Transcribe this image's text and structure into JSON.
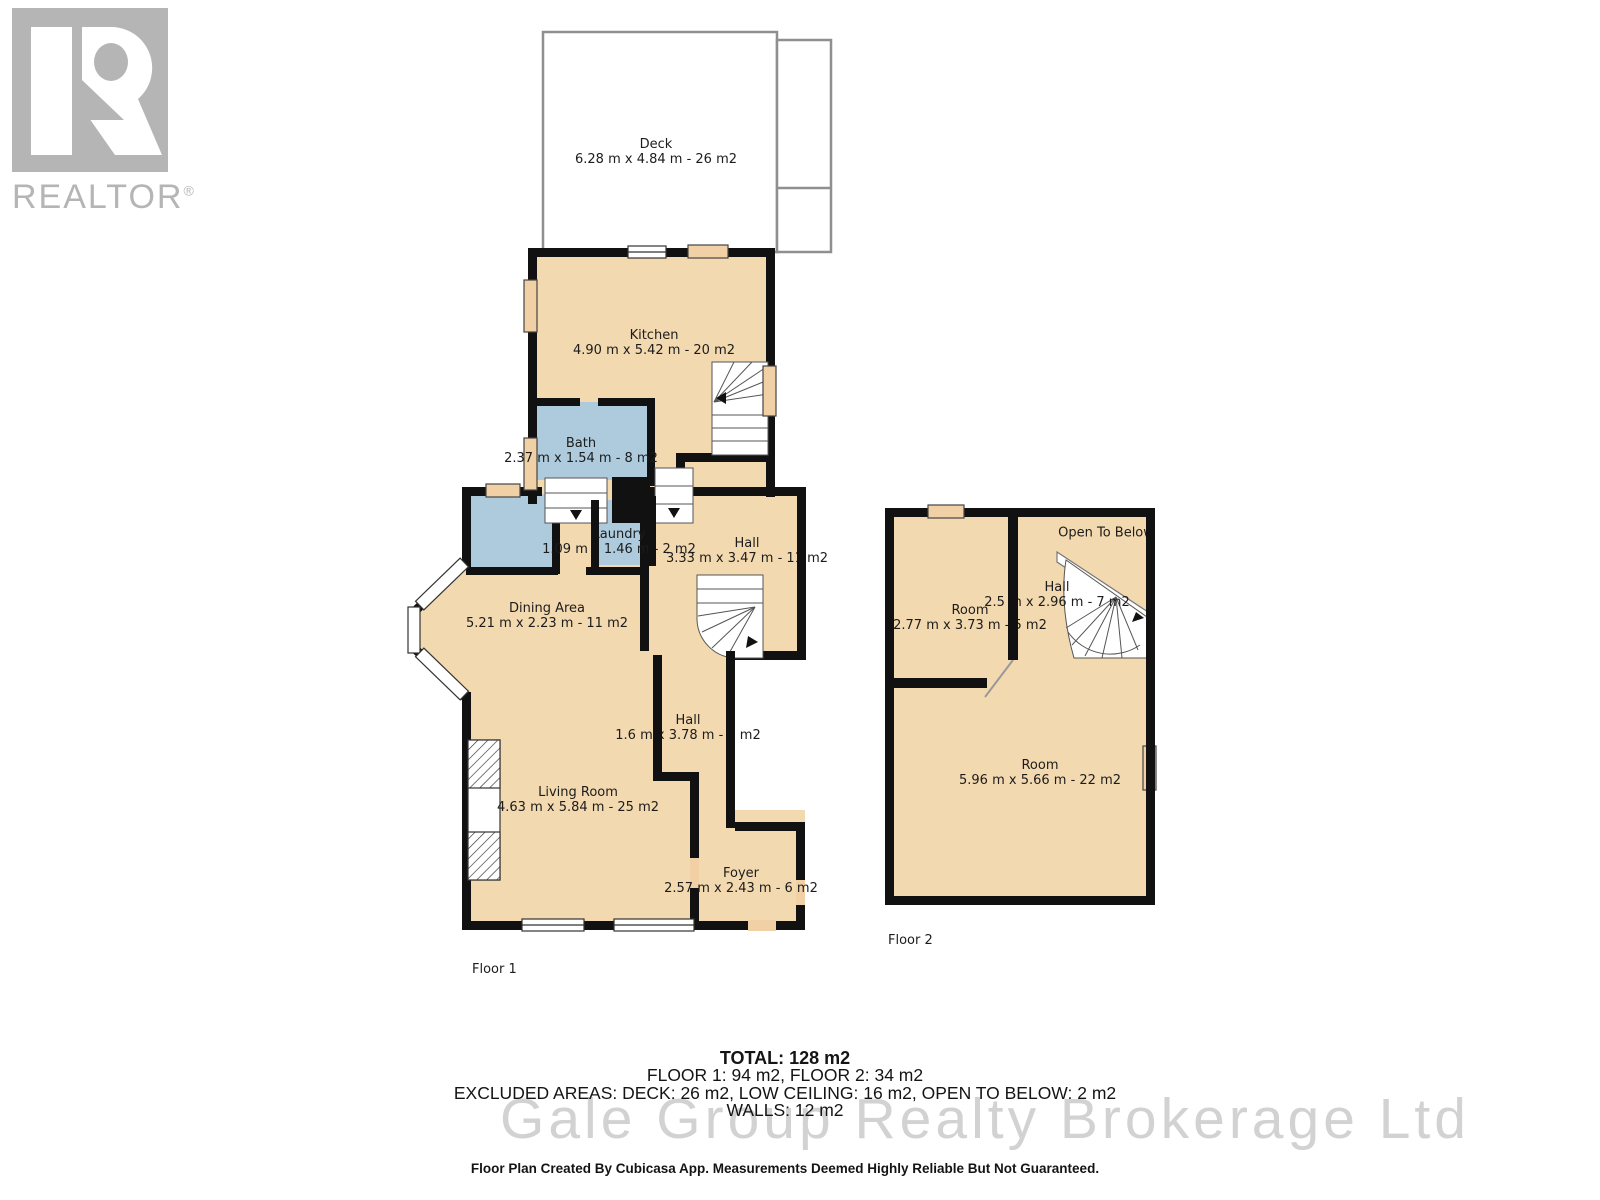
{
  "logo": {
    "brand": "REALTOR",
    "registered": "®"
  },
  "floor1": {
    "label": "Floor 1",
    "rooms": {
      "deck": {
        "name": "Deck",
        "dims": "6.28 m x 4.84 m - 26 m2"
      },
      "kitchen": {
        "name": "Kitchen",
        "dims": "4.90 m x 5.42 m - 20 m2"
      },
      "bath": {
        "name": "Bath",
        "dims": "2.37 m x 1.54 m - 8 m2"
      },
      "laundry": {
        "name": "Laundry",
        "dims": "1.09 m x 1.46 m - 2 m2"
      },
      "hall_upper": {
        "name": "Hall",
        "dims": "3.33 m x 3.47 m - 11 m2"
      },
      "dining": {
        "name": "Dining Area",
        "dims": "5.21 m x 2.23 m - 11 m2"
      },
      "hall_lower": {
        "name": "Hall",
        "dims": "1.6 m x 3.78 m - 6 m2"
      },
      "living": {
        "name": "Living Room",
        "dims": "4.63 m x 5.84 m - 25 m2"
      },
      "foyer": {
        "name": "Foyer",
        "dims": "2.57 m x 2.43 m - 6 m2"
      }
    }
  },
  "floor2": {
    "label": "Floor 2",
    "rooms": {
      "room_small": {
        "name": "Room",
        "dims": "2.77 m x 3.73 m - 5 m2"
      },
      "hall": {
        "name": "Hall",
        "dims": "2.5 m x 2.96 m - 7 m2"
      },
      "open_below": {
        "name": "Open To Below"
      },
      "room_large": {
        "name": "Room",
        "dims": "5.96 m x 5.66 m - 22 m2"
      }
    }
  },
  "summary": {
    "total": "TOTAL: 128 m2",
    "floors": "FLOOR 1: 94 m2, FLOOR 2: 34 m2",
    "excluded": "EXCLUDED AREAS: DECK: 26 m2, LOW CEILING: 16 m2, OPEN TO BELOW: 2 m2",
    "walls": "WALLS: 12 m2"
  },
  "watermark": "Gale Group Realty Brokerage Ltd",
  "disclaimer": "Floor Plan Created By Cubicasa App. Measurements Deemed Highly Reliable But Not Guaranteed.",
  "colors": {
    "room_fill": "#F3D9B0",
    "wet_room_fill": "#AECBDD",
    "wall": "#111111",
    "window_fill": "#F0D0A4",
    "watermark_gray": "#d2d2d2",
    "logo_gray": "#b5b5b5"
  }
}
